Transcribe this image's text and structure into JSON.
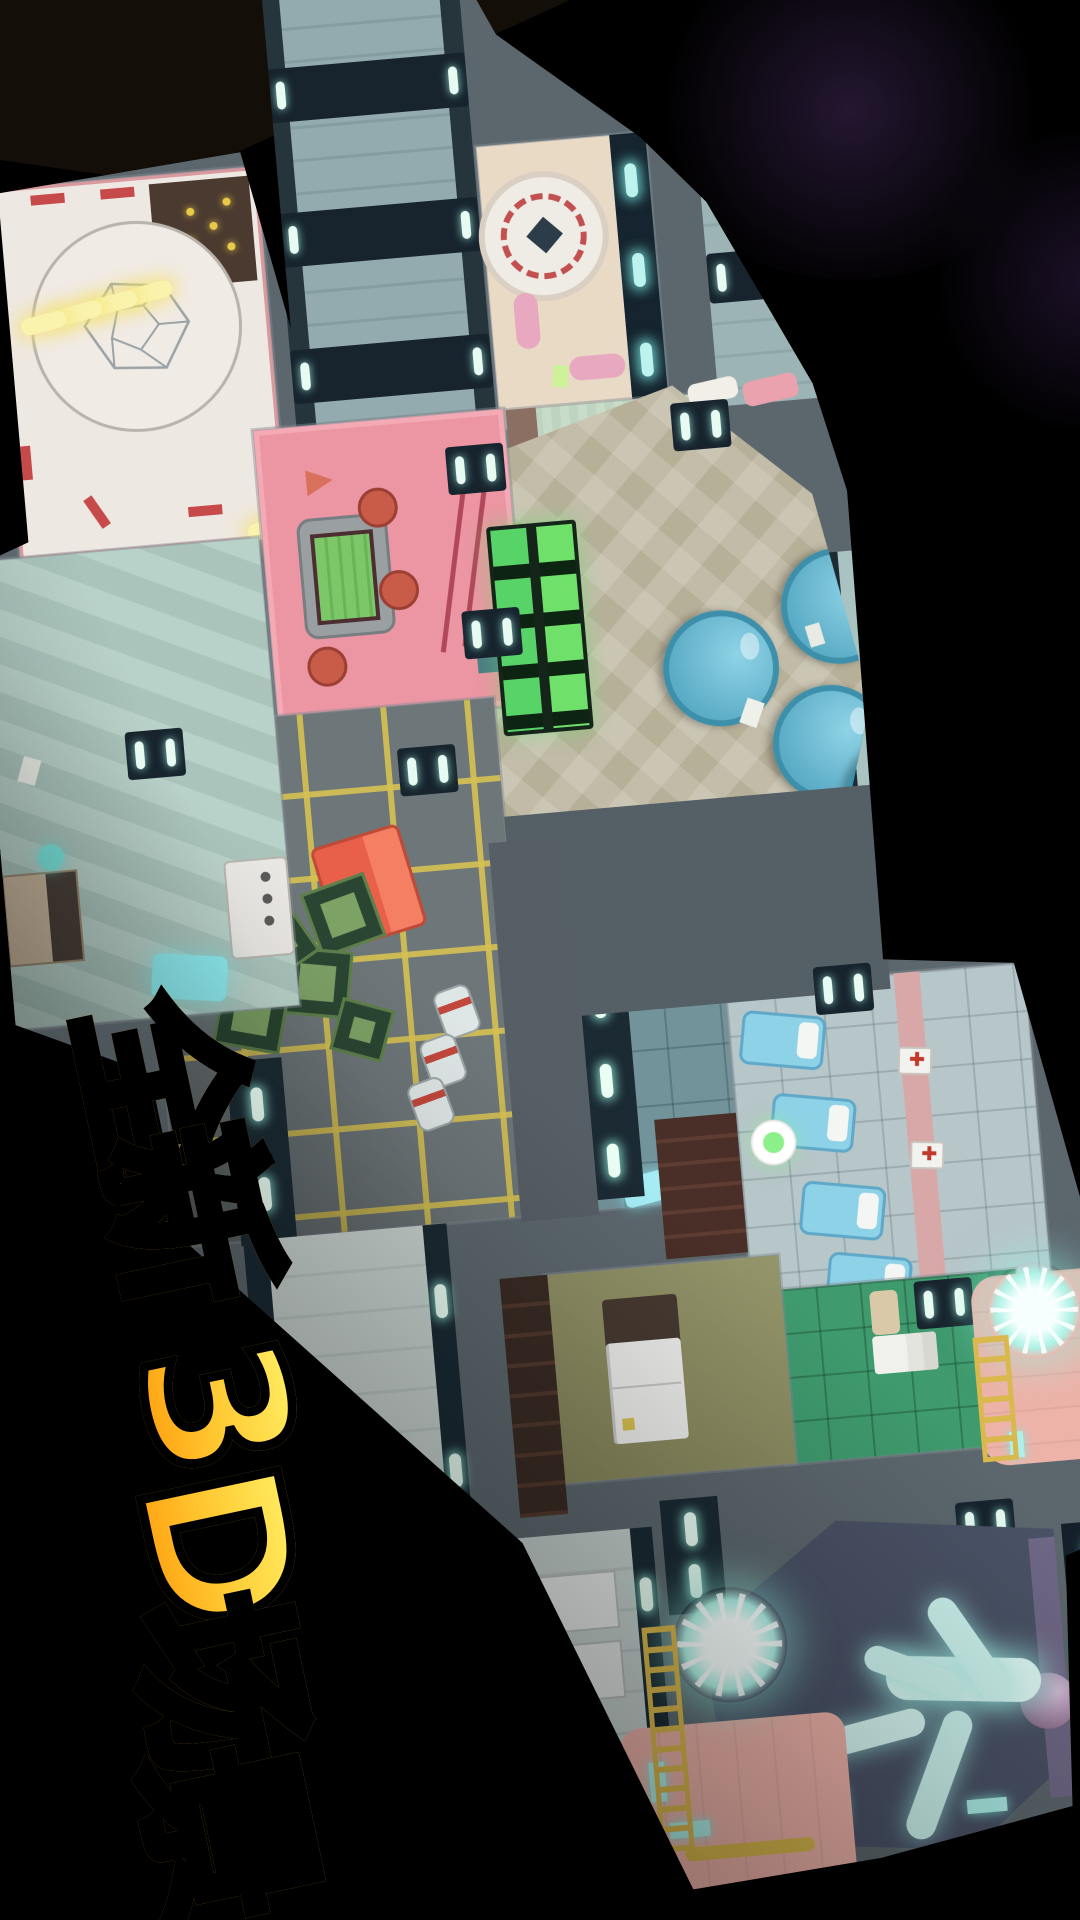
{
  "promo": {
    "caption": "全新3D场景",
    "caption_chars": [
      "全",
      "新",
      "3",
      "D",
      "场",
      "景"
    ],
    "caption_style": {
      "gradient_top": "#ffe95c",
      "gradient_bottom": "#ff9d0e",
      "outline": "#000000"
    }
  },
  "scene": {
    "description": "overhead view of 3D spaceship map floating in space",
    "space_color": "#000000",
    "nebula_color": "#5a3c78",
    "hull_color": "#5c676d",
    "rooms": [
      {
        "name": "launch-pad",
        "floor": "#eee8e2",
        "accent": "#d89a9e",
        "pad_lights": 7
      },
      {
        "name": "reactor-room",
        "floor": "#e9dac6",
        "coil_color": "#c25050"
      },
      {
        "name": "scanner-room",
        "floor": "#c8dcca"
      },
      {
        "name": "cafeteria",
        "floor": "#b7b099",
        "tables": 5,
        "table_color": "#62b7cf"
      },
      {
        "name": "pink-lounge",
        "floor": "#ec96a3",
        "screen_color": "#7cc868",
        "stools": 3
      },
      {
        "name": "office",
        "floor": "#b9d2c9",
        "screen_color": "#8feef2"
      },
      {
        "name": "storage",
        "floor": "#6d7679",
        "grid_color": "#d6c152",
        "crates": 6,
        "red_box": "#e85f4a",
        "cans": 3
      },
      {
        "name": "laboratory",
        "floor": "#73939a",
        "tablet_color": "#a5ecf4"
      },
      {
        "name": "medbay",
        "floor": "#b7c6c9",
        "beds": 4,
        "bed_color": "#8ed2e8"
      },
      {
        "name": "kitchen",
        "floor": "#3f9a6e"
      },
      {
        "name": "pantry",
        "floor": "#8f8f63"
      },
      {
        "name": "fuel-tank-upper",
        "body": "#edb3a9",
        "glow": "#aef2e6",
        "ladder": "#d9b84d"
      },
      {
        "name": "fuel-tank-lower",
        "body": "#ecb2a8",
        "glow": "#aef2e6",
        "ladder": "#d9b84d"
      },
      {
        "name": "engine-room",
        "floor": "#4a5266",
        "thruster_glow": "#c9f7f1"
      }
    ]
  }
}
